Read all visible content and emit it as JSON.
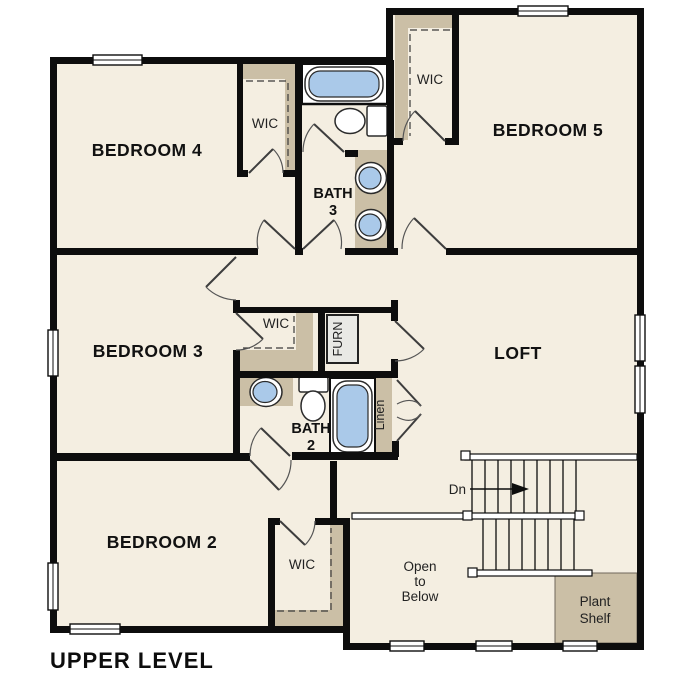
{
  "plan_title": "UPPER LEVEL",
  "rooms": {
    "bedroom4": "BEDROOM 4",
    "bedroom5": "BEDROOM 5",
    "bedroom3": "BEDROOM 3",
    "bedroom2": "BEDROOM 2",
    "loft": "LOFT"
  },
  "bath3": {
    "line1": "BATH",
    "line2": "3"
  },
  "bath2": {
    "line1": "BATH",
    "line2": "2"
  },
  "closets": {
    "walk_in": "WIC",
    "furnace": "FURN",
    "linen": "Linen"
  },
  "stairs": {
    "direction": "Dn"
  },
  "open_to_below": {
    "line1": "Open",
    "line2": "to",
    "line3": "Below"
  },
  "plant_shelf": {
    "line1": "Plant",
    "line2": "Shelf"
  },
  "colors": {
    "floor": "#f4eee1",
    "wall": "#0d0d0d",
    "casework_tan": "#cbbfa6",
    "fixture_blue": "#aac9e9",
    "furnace_gray": "#e9e9e5",
    "background": "#ffffff"
  }
}
